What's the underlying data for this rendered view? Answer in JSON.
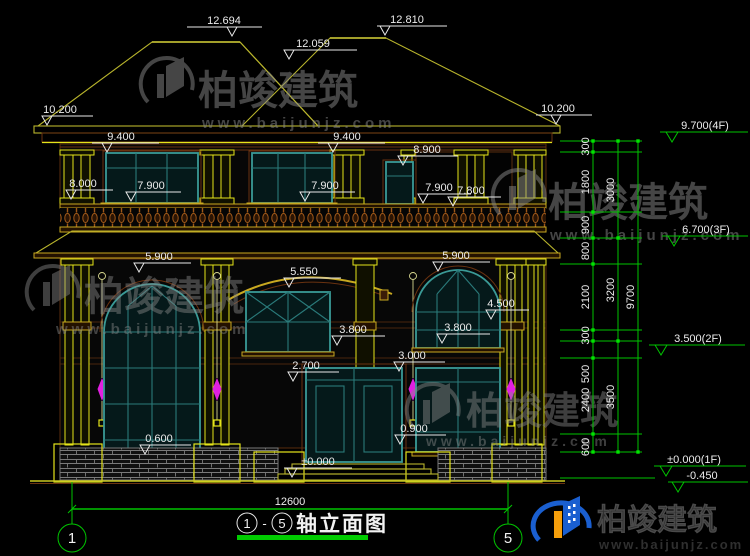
{
  "colors": {
    "background": "#000000",
    "cad_yellow": "#e4e41a",
    "roof_olive": "#b8b42c",
    "window_teal": "#3a9a96",
    "wood_brown": "#a05818",
    "dim_green": "#00c400",
    "dim_white": "#ececec",
    "lamp_magenta": "#e020e0",
    "logo_blue": "#1a5fd0",
    "logo_orange": "#f59e0b",
    "title_underline": "#00cc00"
  },
  "elev": {
    "m12694": "12.694",
    "m12810": "12.810",
    "m12059": "12.059",
    "m10200L": "10.200",
    "m10200R": "10.200",
    "m9400L": "9.400",
    "m9400C": "9.400",
    "m8900": "8.900",
    "m8000": "8.000",
    "m7900L": "7.900",
    "m7900C": "7.900",
    "m7900R": "7.900",
    "m7800": "7.800",
    "m5900L": "5.900",
    "m5550": "5.550",
    "m5900R": "5.900",
    "m4500": "4.500",
    "m3800L": "3.800",
    "m3800R": "3.800",
    "m3000": "3.000",
    "m2700": "2.700",
    "m0600": "0.600",
    "m0900": "0.900",
    "m0000": "±0.000"
  },
  "chain": {
    "segments": [
      "300",
      "1800",
      "900",
      "800",
      "2100",
      "300",
      "500",
      "2400",
      "600"
    ],
    "totals": [
      "3000",
      "3200",
      "3500"
    ],
    "overall": "9700",
    "floors": [
      "9.700(4F)",
      "6.700(3F)",
      "3.500(2F)",
      "±0.000(1F)",
      "-0.450"
    ]
  },
  "dims": {
    "overall_width": "12600"
  },
  "axes": {
    "left": "1",
    "right": "5"
  },
  "title": {
    "axis_from": "1",
    "axis_to": "5",
    "dash": "-",
    "text": "轴立面图"
  },
  "watermark": {
    "brand": "柏竣建筑",
    "url": "www.baijunjz.com"
  },
  "brand": {
    "name": "柏竣建筑",
    "url": "www.baijunjz.com"
  }
}
